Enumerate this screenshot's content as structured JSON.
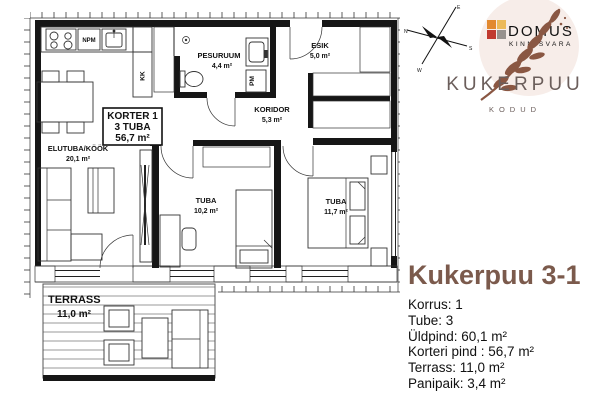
{
  "plan": {
    "korter_box": {
      "line1": "KORTER 1",
      "line2": "3 TUBA",
      "line3": "56,7 m²"
    },
    "rooms": {
      "elutuba": {
        "name": "ELUTUBA/KÖÖK",
        "area": "20,1 m²"
      },
      "pesuruum": {
        "name": "PESURUUM",
        "area": "4,4 m²"
      },
      "esik": {
        "name": "ESIK",
        "area": "5,0 m²"
      },
      "koridor": {
        "name": "KORIDOR",
        "area": "5,3 m²"
      },
      "tuba_small": {
        "name": "TUBA",
        "area": "10,2 m²"
      },
      "tuba_large": {
        "name": "TUBA",
        "area": "11,7 m²"
      },
      "terrass": {
        "name": "TERRASS",
        "area": "11,0 m²"
      }
    },
    "labels": {
      "npm": "NPM",
      "kk": "KK",
      "pm": "PM"
    },
    "compass": {
      "n": "N",
      "e": "E",
      "s": "S",
      "w": "W"
    }
  },
  "brand": {
    "logo_name": "DOMUS",
    "logo_sub": "KINNISVARA",
    "estate_name": "KUKERPUU",
    "estate_sub": "KODUD",
    "colors": {
      "title_brown": "#7B5A4C",
      "brand_text": "#6B5E5B",
      "logo_gray": "#8F8D8C",
      "logo_red": "#C2463C",
      "branch_brown": "#8A5743",
      "logo_bg": "#F7EDE9",
      "square_orange": "#E2892F",
      "square_yellow": "#ECBA5A",
      "square_red": "#C13A30",
      "square_gray": "#98928E"
    }
  },
  "details": {
    "title": "Kukerpuu 3-1",
    "rows": [
      "Korrus: 1",
      "Tube: 3",
      "Üldpind: 60,1 m²",
      "Korteri pind : 56,7 m²",
      "Terrass: 11,0 m²",
      "Panipaik: 3,4 m²"
    ]
  }
}
